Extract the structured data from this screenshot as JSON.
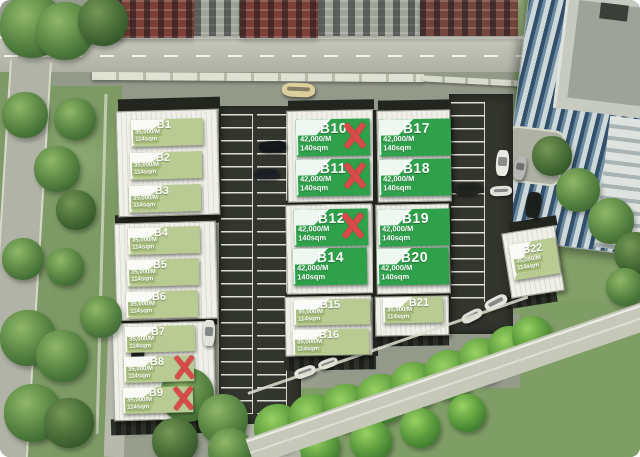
{
  "scene": {
    "description": "Aerial rendering of a warehouse estate with unit availability banners",
    "colors": {
      "banner_green": "#2fa14b",
      "banner_pale_green": "#b9cb92",
      "banner_pale_chip": "#a4bc79",
      "sold_x_red": "#d94b4b",
      "roof_white": "#eceee6",
      "asphalt_gray": "#949a8a",
      "grass_green": "#7f9e66"
    },
    "sold_marker": "X"
  },
  "units": [
    {
      "id": "B1",
      "label": "B1",
      "price": "35,000/M",
      "area": "114sqm",
      "style": "pale",
      "sold": false
    },
    {
      "id": "B2",
      "label": "B2",
      "price": "35,000/M",
      "area": "114sqm",
      "style": "pale",
      "sold": false
    },
    {
      "id": "B3",
      "label": "B3",
      "price": "35,000/M",
      "area": "114sqm",
      "style": "pale",
      "sold": false
    },
    {
      "id": "B4",
      "label": "B4",
      "price": "35,000/M",
      "area": "114sqm",
      "style": "pale",
      "sold": false
    },
    {
      "id": "B5",
      "label": "B5",
      "price": "35,000/M",
      "area": "114sqm",
      "style": "pale",
      "sold": false
    },
    {
      "id": "B6",
      "label": "B6",
      "price": "35,000/M",
      "area": "114sqm",
      "style": "pale",
      "sold": false
    },
    {
      "id": "B7",
      "label": "B7",
      "price": "35,000/M",
      "area": "114sqm",
      "style": "pale",
      "sold": false
    },
    {
      "id": "B8",
      "label": "B8",
      "price": "35,000/M",
      "area": "114sqm",
      "style": "pale",
      "sold": true
    },
    {
      "id": "B9",
      "label": "B9",
      "price": "35,000/M",
      "area": "114sqm",
      "style": "pale",
      "sold": true
    },
    {
      "id": "B10",
      "label": "B10",
      "price": "42,000/M",
      "area": "140sqm",
      "style": "vivid",
      "sold": true
    },
    {
      "id": "B11",
      "label": "B11",
      "price": "42,000/M",
      "area": "140sqm",
      "style": "vivid",
      "sold": true
    },
    {
      "id": "B12",
      "label": "B12",
      "price": "42,000/M",
      "area": "140sqm",
      "style": "vivid",
      "sold": true
    },
    {
      "id": "B14",
      "label": "B14",
      "price": "42,000/M",
      "area": "140sqm",
      "style": "vivid",
      "sold": false
    },
    {
      "id": "B15",
      "label": "B15",
      "price": "35,000/M",
      "area": "114sqm",
      "style": "pale",
      "sold": false
    },
    {
      "id": "B16",
      "label": "B16",
      "price": "35,000/M",
      "area": "114sqm",
      "style": "pale",
      "sold": false
    },
    {
      "id": "B17",
      "label": "B17",
      "price": "42,000/M",
      "area": "140sqm",
      "style": "vivid",
      "sold": false
    },
    {
      "id": "B18",
      "label": "B18",
      "price": "42,000/M",
      "area": "140sqm",
      "style": "vivid",
      "sold": false
    },
    {
      "id": "B19",
      "label": "B19",
      "price": "42,000/M",
      "area": "140sqm",
      "style": "vivid",
      "sold": false
    },
    {
      "id": "B20",
      "label": "B20",
      "price": "42,000/M",
      "area": "140sqm",
      "style": "vivid",
      "sold": false
    },
    {
      "id": "B21",
      "label": "B21",
      "price": "35,000/M",
      "area": "114sqm",
      "style": "pale",
      "sold": false
    },
    {
      "id": "B22",
      "label": "B22",
      "price": "35,000/M",
      "area": "114sqm",
      "style": "pale",
      "sold": false
    }
  ]
}
